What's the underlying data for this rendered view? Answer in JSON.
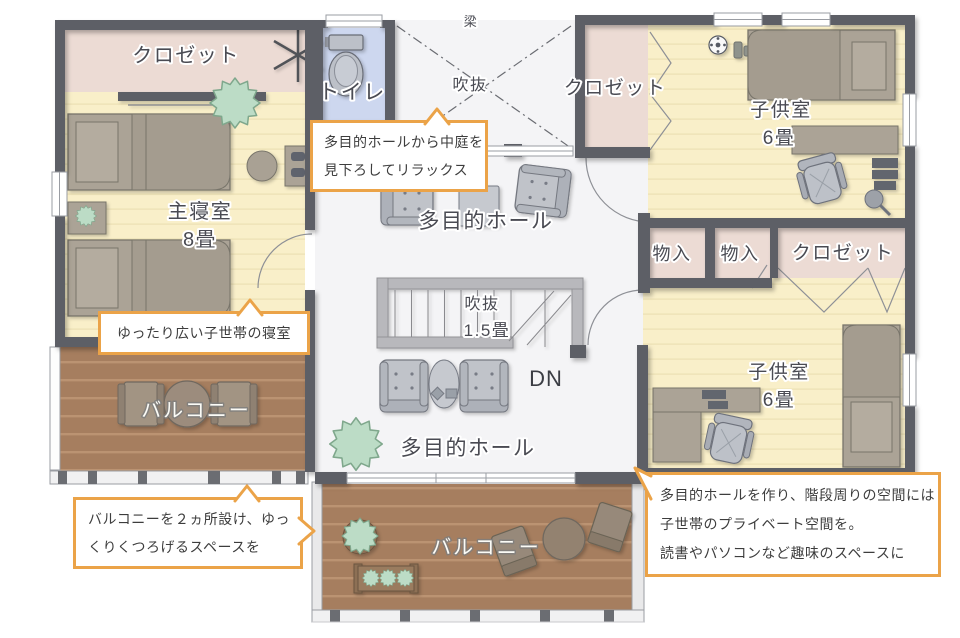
{
  "plan": {
    "labels": {
      "beam": "梁",
      "void_upper": "吹抜",
      "stair_void_name": "吹抜",
      "stair_void_size": "1.5畳",
      "down": "DN",
      "hall_upper": "多目的ホール",
      "hall_lower": "多目的ホール"
    },
    "rooms": {
      "master_closet": "クロゼット",
      "toilet": "トイレ",
      "master_name": "主寝室",
      "master_size": "8畳",
      "child1_closet": "クロゼット",
      "child1_name": "子供室",
      "child1_size": "6畳",
      "storage1": "物入",
      "storage2": "物入",
      "child2_closet": "クロゼット",
      "child2_name": "子供室",
      "child2_size": "6畳",
      "balcony_left": "バルコニー",
      "balcony_bottom": "バルコニー"
    },
    "callouts": {
      "view": {
        "line1": "多目的ホールから中庭を",
        "line2": "見下ろしてリラックス"
      },
      "bedroom": {
        "line1": "ゆったり広い子世帯の寝室"
      },
      "balcony": {
        "line1": "バルコニーを２ヵ所設け、ゆっ",
        "line2": "くりくつろげるスペースを"
      },
      "private": {
        "line1": "多目的ホールを作り、階段周りの空間には",
        "line2": "子世帯のプライベート空間を。",
        "line3": "読書やパソコンなど趣味のスペースに"
      }
    },
    "colors": {
      "wall": "#5d5f66",
      "floor_wood": "#f9efc9",
      "closet_pink": "#ecdbd4",
      "toilet_blue": "#cdd7ef",
      "hall_white": "#f4f4f6",
      "deck_brown": "#a67e5f",
      "callout_border": "#eba348",
      "plant_green": "#bcdcc6",
      "label_gray": "#4a4b53"
    }
  }
}
